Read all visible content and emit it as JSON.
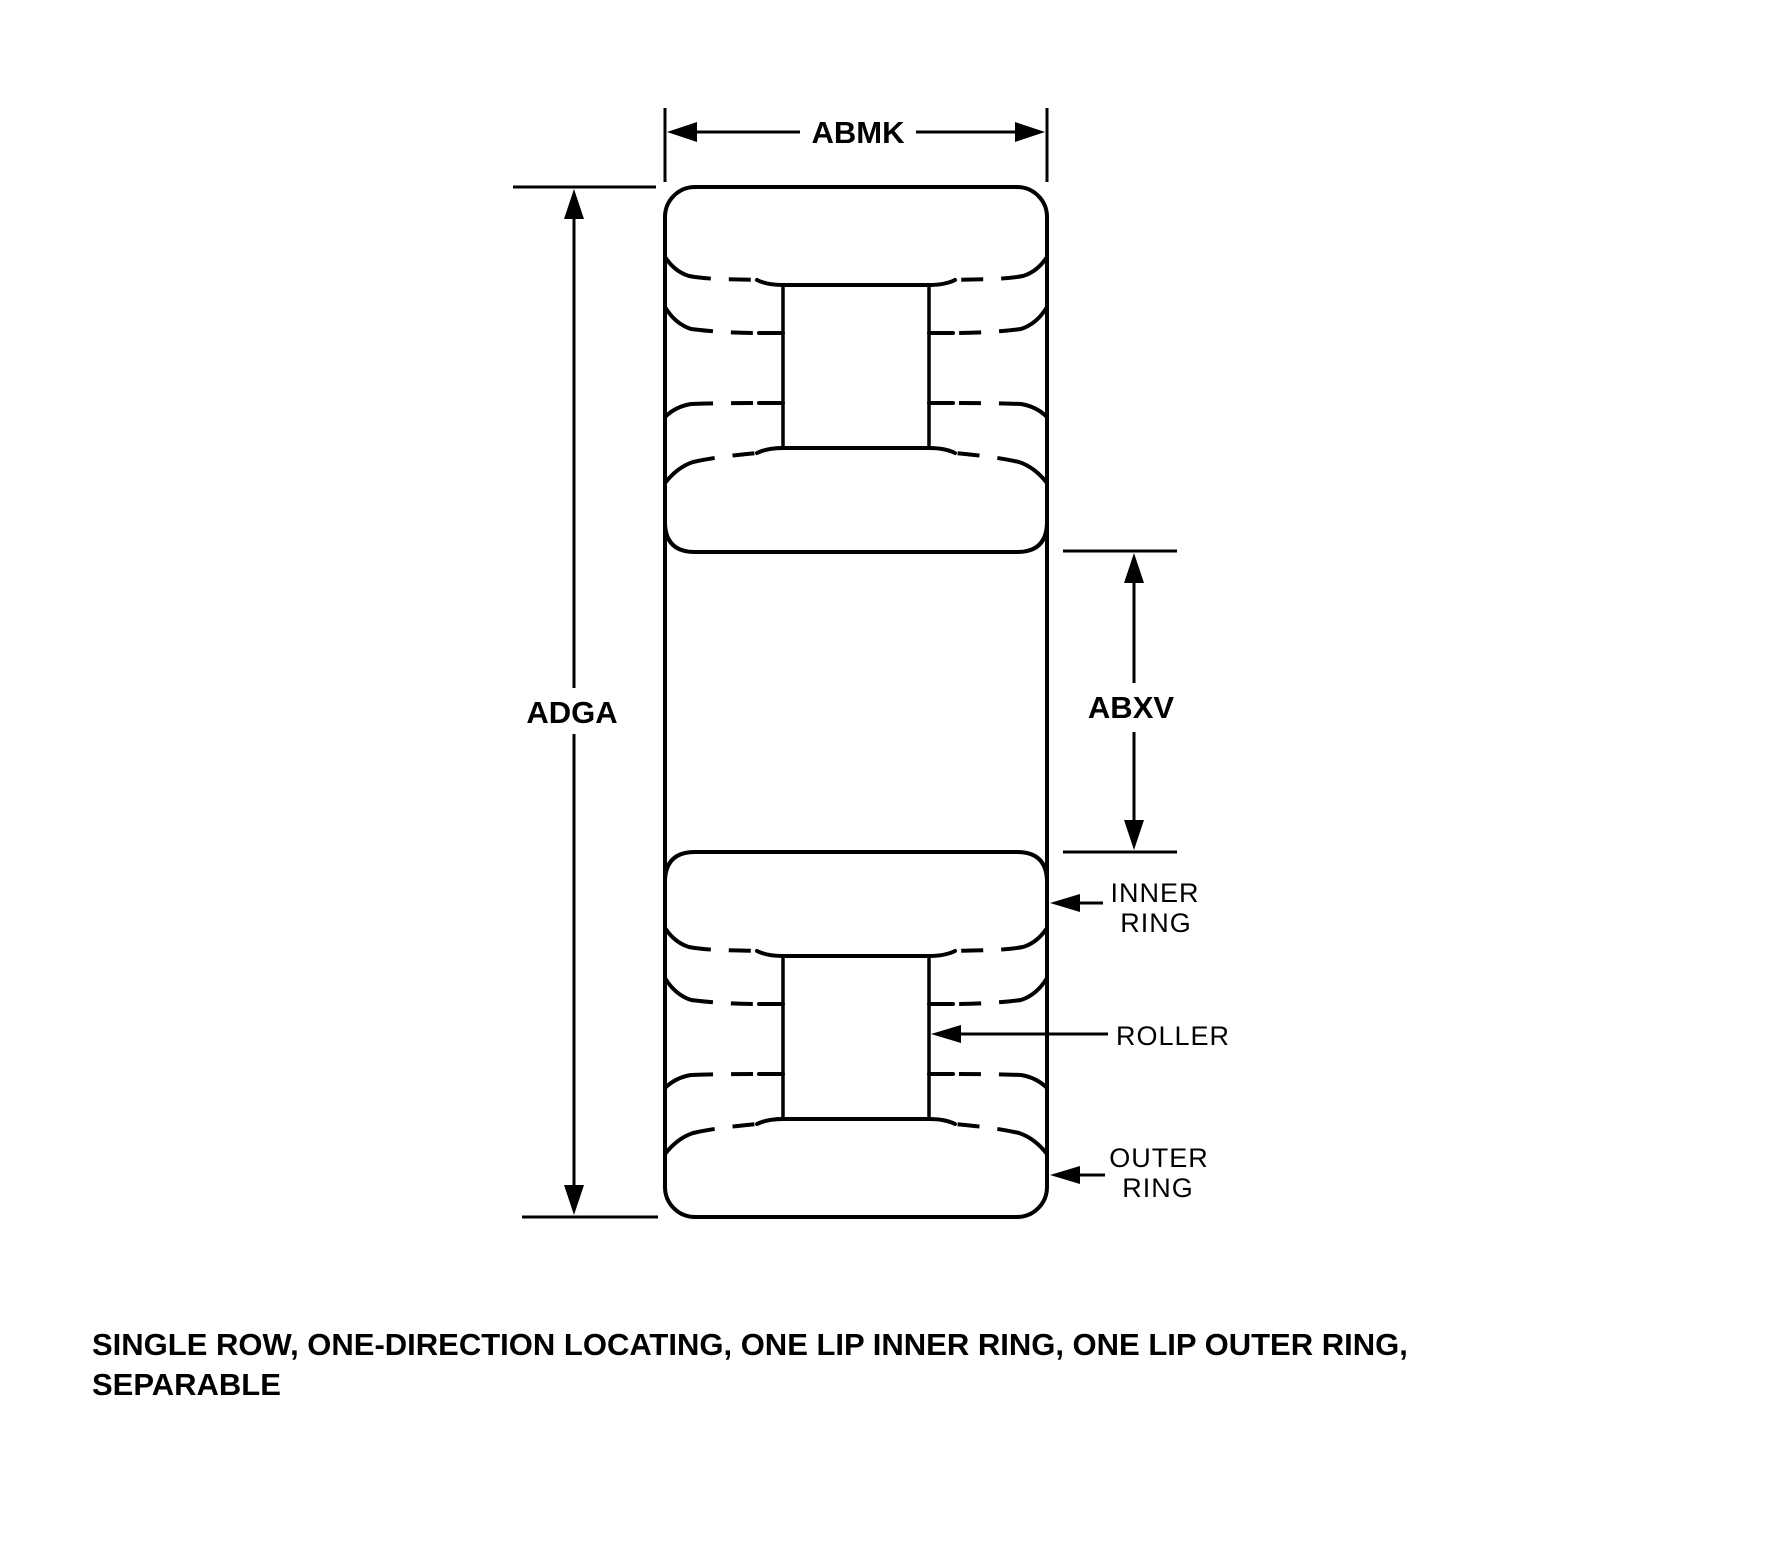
{
  "diagram": {
    "dimension_labels": {
      "width": "ABMK",
      "outer_diameter": "ADGA",
      "bore": "ABXV"
    },
    "part_callouts": {
      "inner_ring": {
        "line1": "INNER",
        "line2": "RING"
      },
      "roller": {
        "label": "ROLLER"
      },
      "outer_ring": {
        "line1": "OUTER",
        "line2": "RING"
      }
    },
    "caption": {
      "line1": "SINGLE ROW, ONE-DIRECTION LOCATING, ONE LIP INNER RING, ONE LIP OUTER RING,",
      "line2": "SEPARABLE"
    },
    "colors": {
      "ink": "#000000",
      "background": "#ffffff"
    }
  }
}
